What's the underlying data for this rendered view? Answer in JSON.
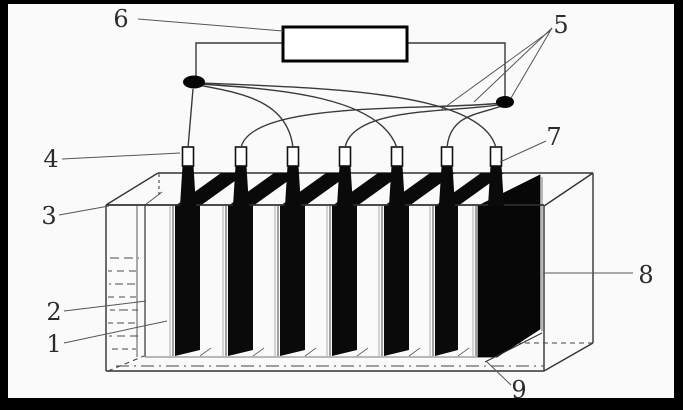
{
  "figure": {
    "type": "technical line diagram of an electrolytic cell / battery tank",
    "callouts": [
      {
        "text": "1"
      },
      {
        "text": "2"
      },
      {
        "text": "3"
      },
      {
        "text": "4"
      },
      {
        "text": "5"
      },
      {
        "text": "6"
      },
      {
        "text": "7"
      },
      {
        "text": "8"
      },
      {
        "text": "9"
      }
    ],
    "structure": {
      "electrode_tab_count": 7,
      "terminal_node_count": 2,
      "power_box_count": 1
    },
    "colors": {
      "frame": "#000000",
      "background": "#fafafa",
      "ink": "#2b2b2b",
      "plate_fill": "#0a0a0a",
      "wire": "#3a3a3a",
      "leader_line": "#555555"
    }
  }
}
